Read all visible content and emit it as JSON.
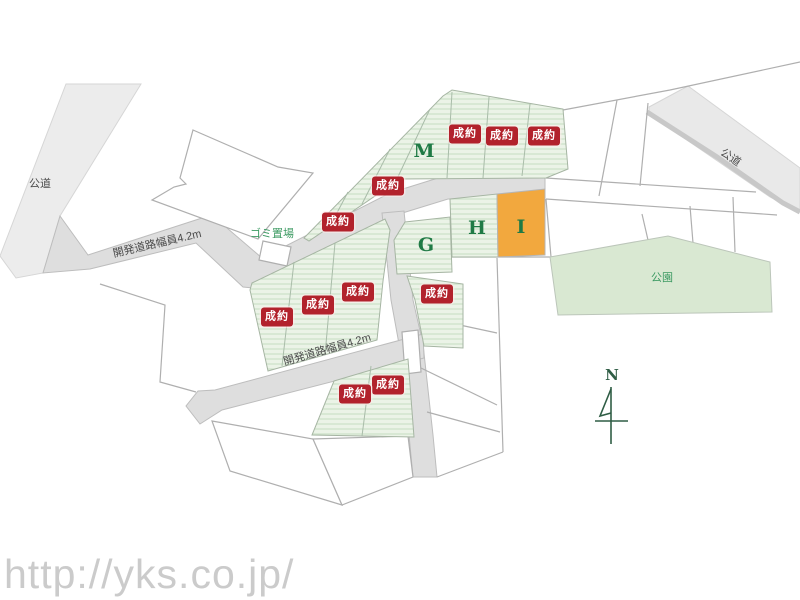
{
  "map": {
    "roads": {
      "public_top_left_label": "公道",
      "public_top_right_label": "公道",
      "dev_upper_label": "開発道路幅員4.2m",
      "dev_lower_label": "開発道路幅員4.2m"
    },
    "park_label": "公園",
    "garbage_label": "ゴミ置場",
    "compass_label": "N",
    "sold_badge_label": "成約",
    "sold_count": 11,
    "sold_lots": [
      {
        "x": 465,
        "y": 134
      },
      {
        "x": 502,
        "y": 136
      },
      {
        "x": 544,
        "y": 136
      },
      {
        "x": 388,
        "y": 186
      },
      {
        "x": 338,
        "y": 222
      },
      {
        "x": 358,
        "y": 292
      },
      {
        "x": 318,
        "y": 305
      },
      {
        "x": 277,
        "y": 317
      },
      {
        "x": 437,
        "y": 294
      },
      {
        "x": 388,
        "y": 385
      },
      {
        "x": 355,
        "y": 394
      }
    ],
    "named_lots": [
      {
        "id": "M",
        "x": 424,
        "y": 151,
        "highlight": false
      },
      {
        "id": "G",
        "x": 426,
        "y": 245,
        "highlight": false
      },
      {
        "id": "H",
        "x": 477,
        "y": 228,
        "highlight": false
      },
      {
        "id": "I",
        "x": 521,
        "y": 227,
        "highlight": true
      }
    ],
    "colors": {
      "sold_badge": "#B2222C",
      "lot_green": "#EBF3E7",
      "hatch": "#C9DFC5",
      "park": "#D9E8D2",
      "highlight_lot": "#F2A83E",
      "letter_green": "#1F7A45",
      "label_green": "#3C9A62",
      "road_gray": "#DEDEDE",
      "line_gray": "#AFAFAF",
      "watermark": "#CBCBCB"
    }
  },
  "page": {
    "watermark_url": "http://yks.co.jp/"
  }
}
